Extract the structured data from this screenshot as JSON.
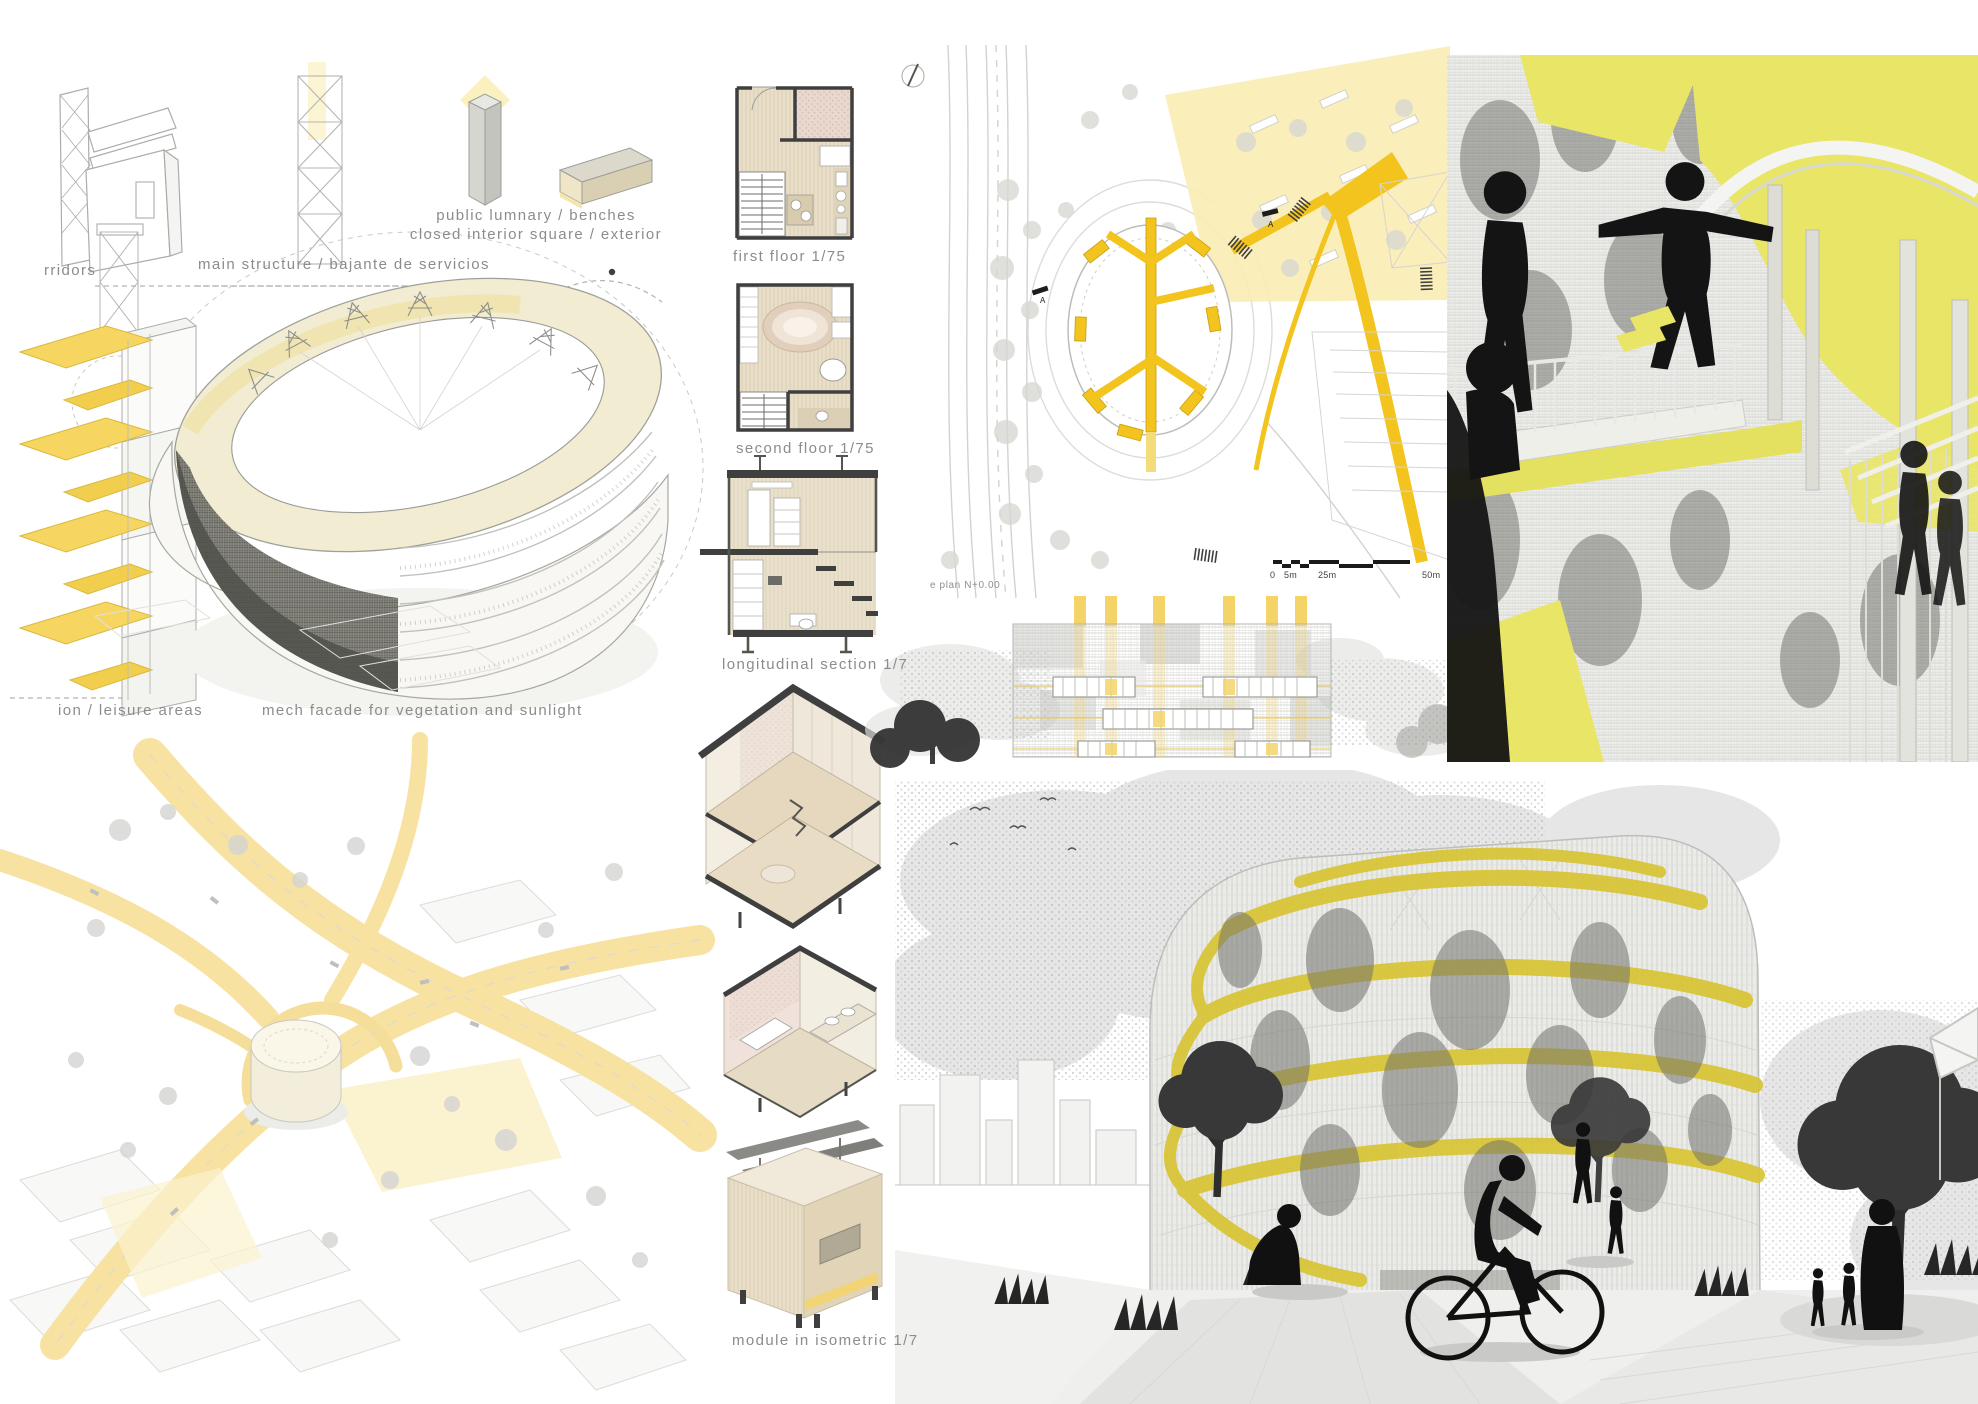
{
  "board": {
    "kind": "architecture competition presentation panel",
    "colors": {
      "accent_yellow": "#F2C41D",
      "pale_yellow": "#FAECB4",
      "butter_yellow": "#F7E2A2",
      "lemon_yellow": "#E9E567",
      "ramp_yellow": "#D9C437",
      "wood_beige": "#E7DCC6",
      "line_gray": "#ABABAB",
      "text_gray": "#8C8C8C",
      "ink": "#3F3F3F"
    }
  },
  "concept": {
    "corridors_label": "rridors",
    "main_structure_label": "main structure / bajante de servicios",
    "lumnary_label_line1": "public lumnary / benches",
    "lumnary_label_line2": "closed interior square / exterior",
    "leisure_label": "ion / leisure areas",
    "mech_facade_label": "mech facade for vegetation and sunlight"
  },
  "drawings": {
    "first_floor_label": "first floor 1/75",
    "second_floor_label": "second floor 1/75",
    "longitudinal_section_label": "longitudinal section 1/7",
    "module_isometric_label": "module in isometric 1/7"
  },
  "site_plan": {
    "caption": "e plan N+0.00",
    "section_marker_a": "A",
    "scale_bar": {
      "zero": "0",
      "five_m": "5m",
      "twentyfive_m": "25m",
      "fifty_m": "50m"
    }
  }
}
